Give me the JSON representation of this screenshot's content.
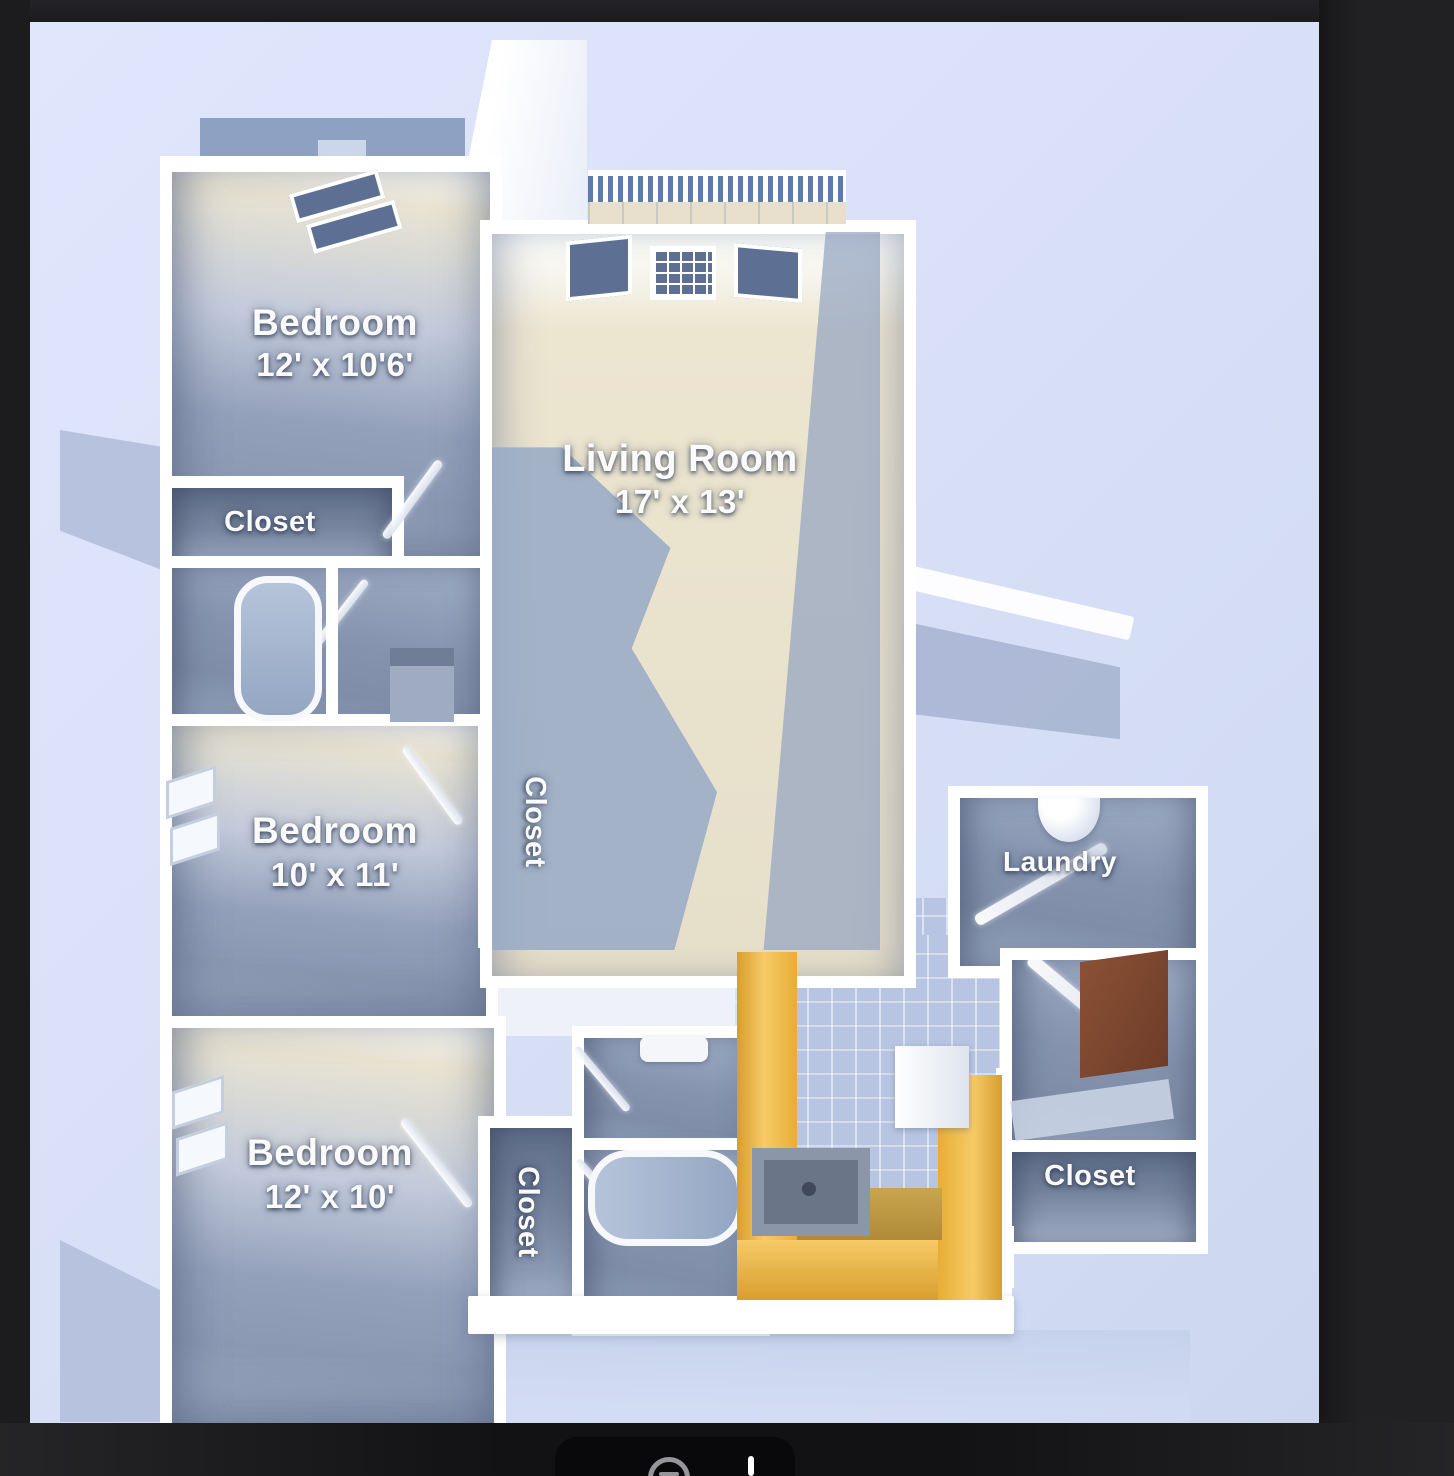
{
  "rooms": {
    "bedroom1": {
      "name": "Bedroom",
      "dims": "12' x 10'6'"
    },
    "living_room": {
      "name": "Living Room",
      "dims": "17' x 13'"
    },
    "closet_top": {
      "label": "Closet"
    },
    "bedroom2": {
      "name": "Bedroom",
      "dims": "10' x 11'"
    },
    "closet_center": {
      "label": "Closet"
    },
    "laundry": {
      "label": "Laundry"
    },
    "bedroom3": {
      "name": "Bedroom",
      "dims": "12' x 10'"
    },
    "closet_bottom": {
      "label": "Closet"
    },
    "closet_right": {
      "label": "Closet"
    }
  },
  "toolbar": {
    "icons": [
      "zoom-out-icon",
      "divider-bar"
    ]
  },
  "colors": {
    "frame": "#1c1c1e",
    "photo_background": "#dbe2f8",
    "wall": "#ffffff",
    "floor_blue": "#8c99b3",
    "floor_cream": "#e9e2cd",
    "counter_amber": "#e8ae35",
    "mirror_brown": "#7c4a32",
    "railing_blue": "#5f7bac"
  }
}
